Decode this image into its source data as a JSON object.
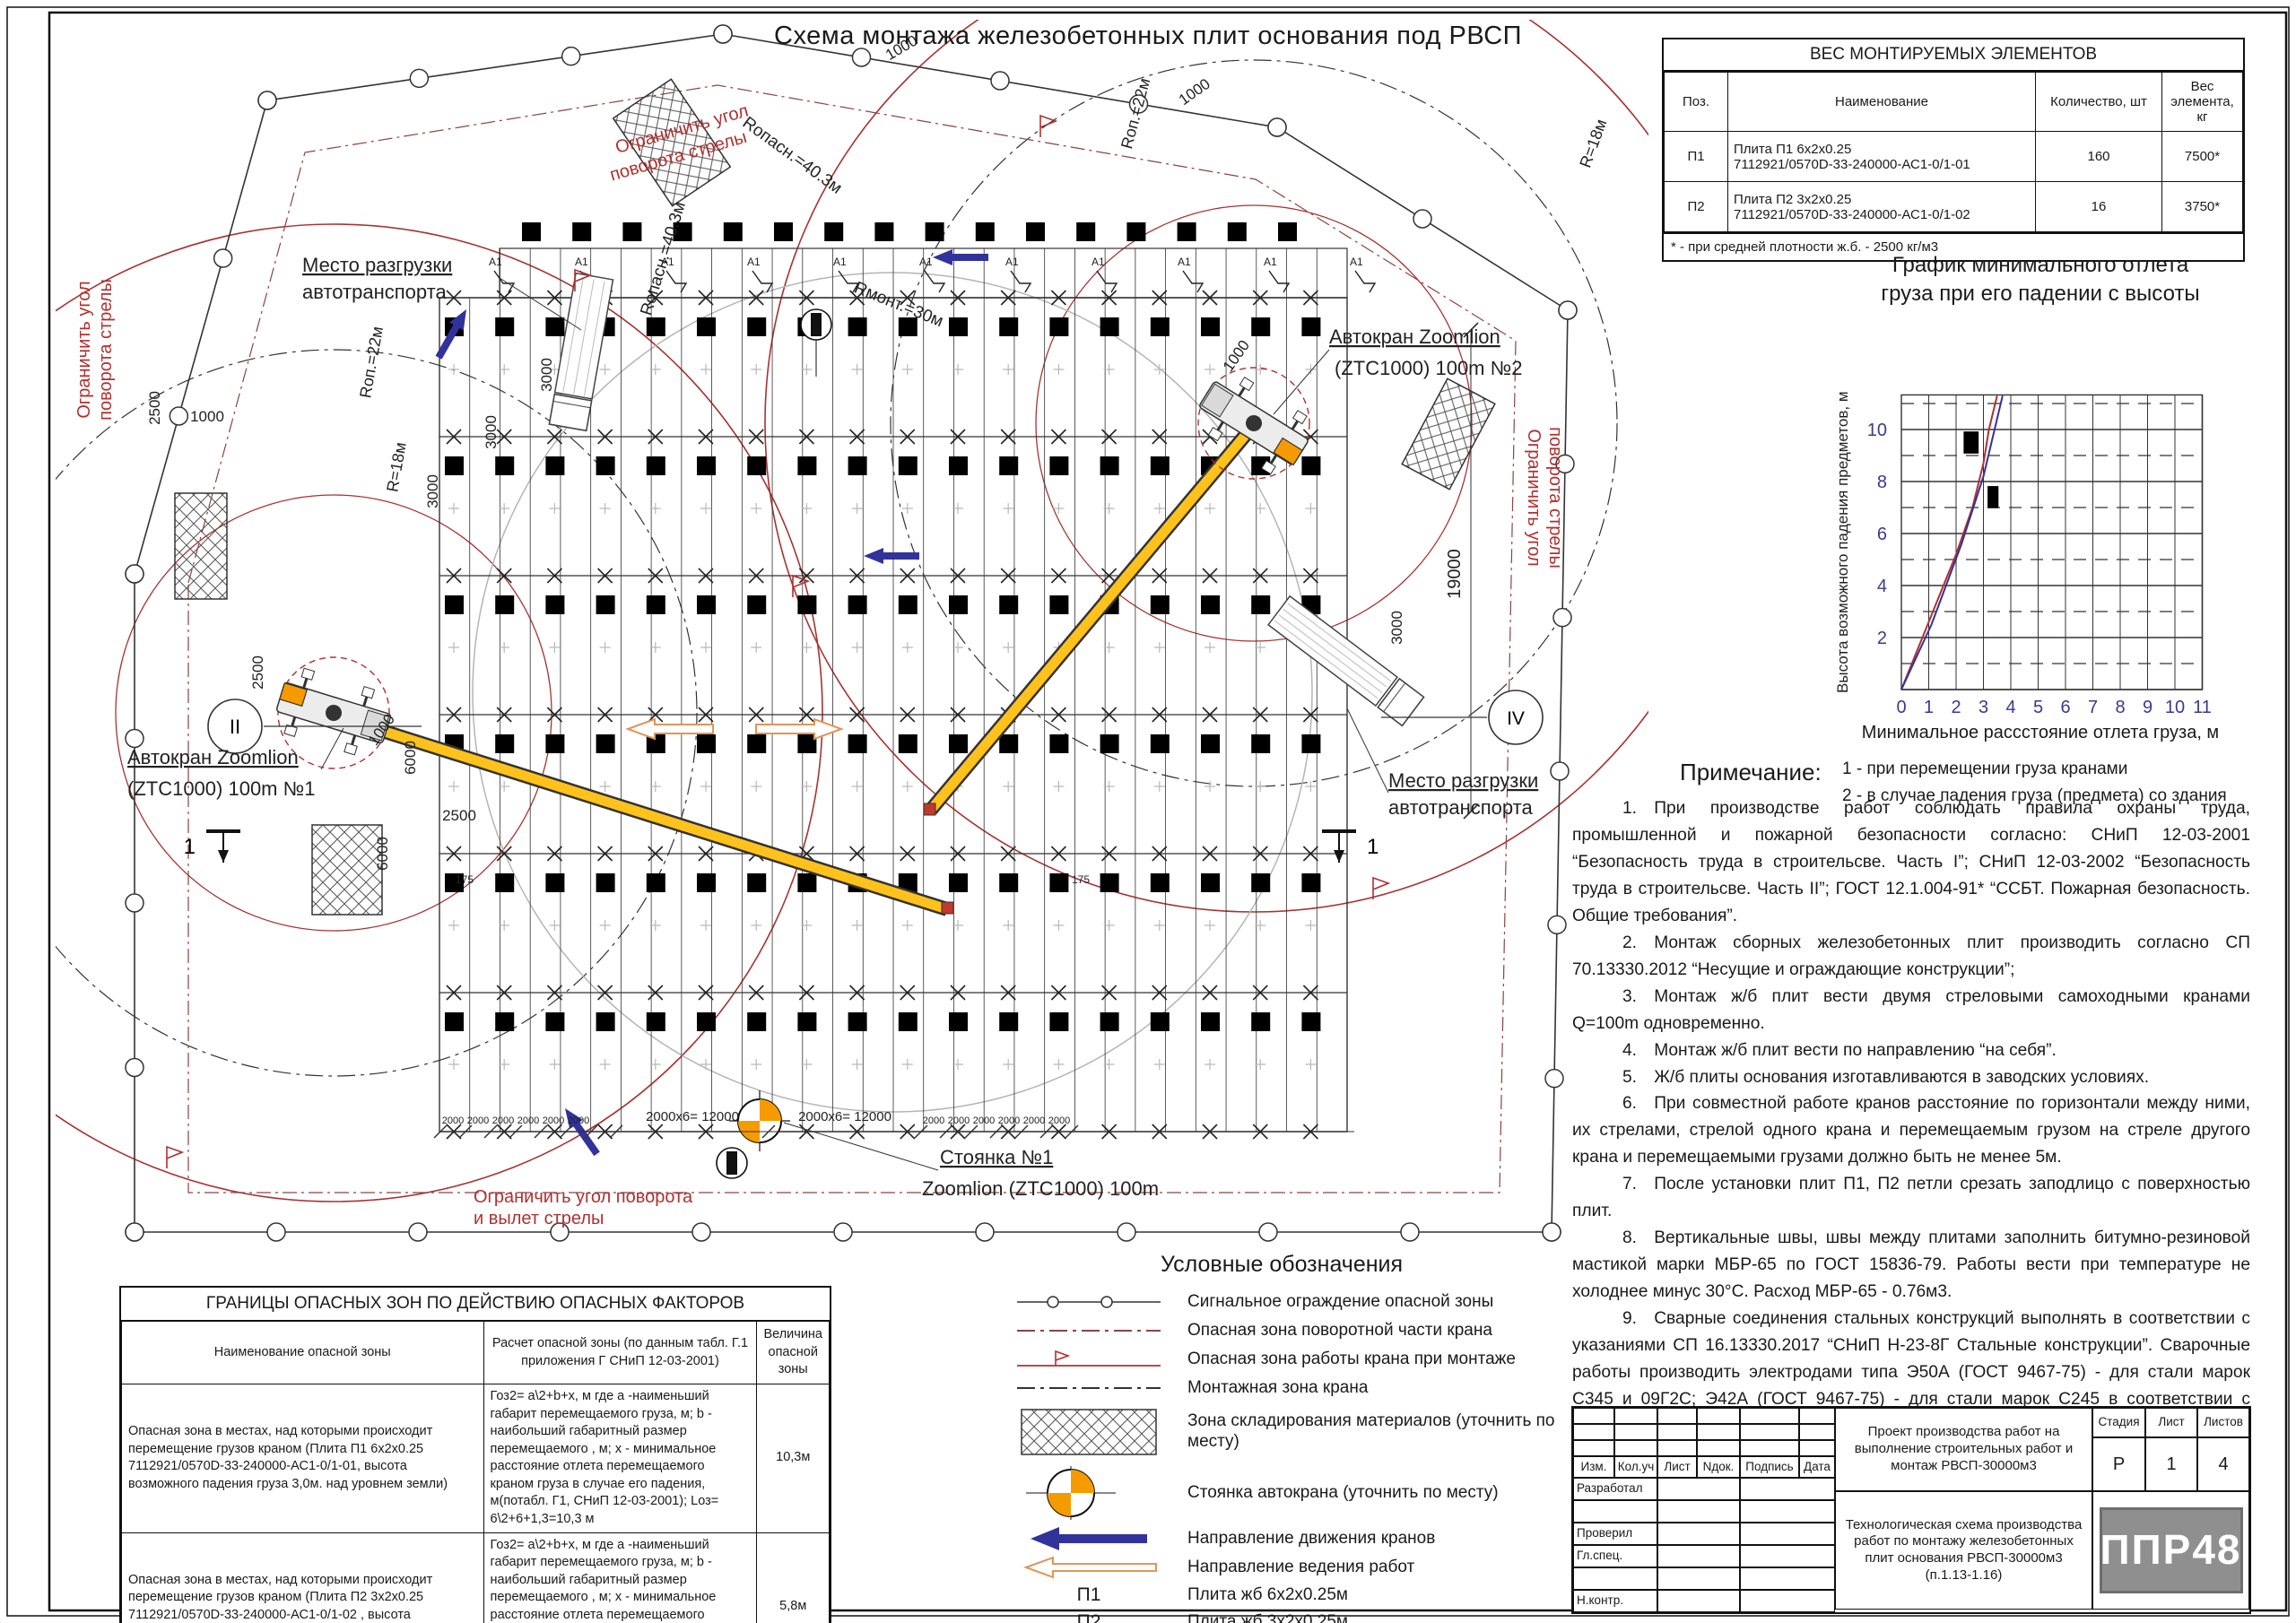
{
  "colors": {
    "red": "#b03030",
    "darkred": "#8a4444",
    "orange": "#f59b00",
    "yellow": "#ffc21c",
    "blue": "#32329b",
    "peach": "#e0955a",
    "grey_line": "#b5b5b5"
  },
  "title": "Схема монтажа железобетонных плит основания под РВСП",
  "weight_table": {
    "title": "ВЕС МОНТИРУЕМЫХ ЭЛЕМЕНТОВ",
    "col_pos": "Поз.",
    "col_name": "Наименование",
    "col_qty": "Количество, шт",
    "col_wt": "Вес элемента, кг",
    "rows": [
      {
        "pos": "П1",
        "name1": "Плита П1 6х2х0.25",
        "name2": "7112921/0570D-33-240000-АС1-0/1-01",
        "qty": "160",
        "wt": "7500*"
      },
      {
        "pos": "П2",
        "name1": "Плита П2 3х2х0.25",
        "name2": "7112921/0570D-33-240000-АС1-0/1-02",
        "qty": "16",
        "wt": "3750*"
      }
    ],
    "footnote": "* - при средней плотности ж.б. - 2500 кг/м3"
  },
  "chart": {
    "title1": "График минимального отлета",
    "title2": "груза при его падении с высоты",
    "note1": "1 - при перемещении груза кранами",
    "note2": "2 - в случае падения груза (предмета) со здания"
  },
  "chart_data": {
    "type": "line",
    "title": "График минимального отлета груза при его падении с высоты",
    "xlabel": "Минимальное рассстояние отлета груза, м",
    "ylabel": "Высота возможного падения предметов, м",
    "xlim": [
      0,
      11
    ],
    "ylim": [
      0,
      11.3
    ],
    "xticks": [
      0,
      1,
      2,
      3,
      4,
      5,
      6,
      7,
      8,
      9,
      10,
      11
    ],
    "yticks": [
      2,
      4,
      6,
      8,
      10
    ],
    "grid": "vertical solid each unit; horizontal solid at even, dashed at odd; legend below",
    "series": [
      {
        "name": "1 - при перемещении груза кранами",
        "color": "#b03030",
        "x": [
          0,
          1,
          2,
          2.6,
          3.0,
          3.2,
          3.5
        ],
        "y": [
          0,
          2.6,
          5.2,
          7.0,
          8.7,
          10.0,
          11.3
        ]
      },
      {
        "name": "2 - в случае падения груза (предмета) со здания",
        "color": "#32329b",
        "x": [
          0,
          1.1,
          2.2,
          3.0,
          3.7
        ],
        "y": [
          0,
          2.5,
          5.6,
          8.2,
          11.3
        ]
      }
    ],
    "markers": [
      {
        "x": 2.55,
        "y": 9.5,
        "w": 0.55,
        "h": 0.85
      },
      {
        "x": 3.35,
        "y": 7.4,
        "w": 0.4,
        "h": 0.85
      }
    ]
  },
  "notes": {
    "title": "Примечание:",
    "items": [
      "1. При производстве работ соблюдать правила охраны труда, промышленной и пожарной безопасности согласно: СНиП 12-03-2001 “Безопасность труда в строительсве. Часть I”; СНиП 12-03-2002 “Безопасность труда в строительсве. Часть II”; ГОСТ 12.1.004-91* “ССБТ. Пожарная безопасность. Общие требования”.",
      "2. Монтаж сборных железобетонных плит производить согласно СП 70.13330.2012 “Несущие и ограждающие конструкции”;",
      "3. Монтаж ж/б плит вести двумя стреловыми самоходными кранами Q=100m одновременно.",
      "4. Монтаж ж/б плит вести по направлению “на себя”.",
      "5. Ж/б плиты основания изготавливаются в заводских условиях.",
      "6. При совместной работе кранов расстояние по горизонтали между ними, их стрелами, стрелой одного крана и перемещаемым грузом на стреле другого крана и перемещаемыми грузами должно быть не менее 5м.",
      "7. После установки плит П1, П2 петли срезать заподлицо с поверхностью плит.",
      "8. Вертикальные швы, швы между плитами заполнить битумно-резиновой мастикой марки МБР-65 по ГОСТ 15836-79. Работы вести при температуре не холоднее минус 30°С. Расход МБР-65 - 0.76м3.",
      "9. Сварные соединения стальных конструкций выполнять в соответствии с указаниями СП 16.13330.2017 “СНиП Н-23-8Г Стальные конструкции”. Сварочные работы производить электродами типа Э50А (ГОСТ 9467-75) - для стали марок С345 и 09Г2С; Э42А (ГОСТ 9467-75) - для стали марок С245 в соответствии с требованиями ГОСТ 5264-80. Высоту шва принять по наименьшей толщине свариваемых элементов.",
      "10. Разрез 1-1 смотри лист 2."
    ]
  },
  "danger_table": {
    "title": "ГРАНИЦЫ ОПАСНЫХ ЗОН ПО ДЕЙСТВИЮ ОПАСНЫХ ФАКТОРОВ",
    "h_name": "Наименование опасной зоны",
    "h_calc": "Расчет опасной зоны (по данным табл. Г.1 приложения Г СНиП 12-03-2001)",
    "h_val": "Величина опасной зоны",
    "rows": [
      {
        "name": "Опасная зона в местах, над которыми происходит перемещение грузов краном (Плита П1 6х2х0.25 7112921/0570D-33-240000-АС1-0/1-01, высота возможного падения груза 3,0м. над уровнем земли)",
        "calc": "Гоз2= а\\2+b+х, м где а -наименьший габарит перемещаемого груза, м; b - наибольший габаритный размер перемещаемого , м; х - минимальное расстояние отлета перемещаемого краном груза в случае его падения, м(потабл. Г1, СНиП 12-03-2001); Lоз= 6\\2+6+1,3=10,3 м",
        "val": "10,3м"
      },
      {
        "name": "Опасная зона в местах, над которыми происходит перемещение грузов краном (Плита П2 3х2х0.25 7112921/0570D-33-240000-АС1-0/1-02 , высота возможного падения груза 3,0м. над уровнем земли)",
        "calc": "Гоз2= а\\2+b+х, м где а -наименьший габарит перемещаемого груза, м; b - наибольший габаритный размер перемещаемого , м; х - минимальное расстояние отлета перемещаемого краном груза в случае его падения, м(потабл. Г1, СНиП 12-03-2001); Lоз= 3\\2+3+1,3=5,8 м",
        "val": "5,8м"
      }
    ]
  },
  "legend": {
    "title": "Условные обозначения",
    "items": [
      {
        "icon": "signal-fence",
        "label": "Сигнальное ограждение опасной зоны"
      },
      {
        "icon": "red-dashdot",
        "label": "Опасная зона поворотной части крана"
      },
      {
        "icon": "red-flag-line",
        "label": "Опасная зона работы крана при монтаже"
      },
      {
        "icon": "black-dashdot",
        "label": "Монтажная зона крана"
      },
      {
        "icon": "hatch-zone",
        "label": "Зона складирования материалов (уточнить по месту)"
      },
      {
        "icon": "crane-parking",
        "label": "Стоянка автокрана (уточнить по месту)"
      },
      {
        "icon": "blue-arrow",
        "label": "Направление движения кранов"
      },
      {
        "icon": "orange-arrow",
        "label": "Направление ведения работ"
      },
      {
        "icon": "П1",
        "label": "Плита жб 6х2х0.25м"
      },
      {
        "icon": "П2",
        "label": "Плита жб 3х2х0.25м"
      },
      {
        "icon": "А1",
        "label": "Анкер Ф10А240"
      }
    ]
  },
  "stamp": {
    "rev_cols": [
      "Изм.",
      "Кол.уч",
      "Лист",
      "Nдок.",
      "Подпись",
      "Дата"
    ],
    "roles": [
      "Разработал",
      "",
      "Проверил",
      "Гл.спец.",
      "",
      "Н.контр."
    ],
    "doc1": "Проект производства работ на выполнение строительных работ и монтаж РВСП-30000м3",
    "doc2": "Технологическая схема производства работ по монтажу железобетонных плит основания РВСП-30000м3  (п.1.13-1.16)",
    "stage_h": "Стадия",
    "sheet_h": "Лист",
    "sheets_h": "Листов",
    "stage": "Р",
    "sheet": "1",
    "sheets": "4",
    "logo": "ППР48"
  },
  "plan": {
    "unload1": "Место разгрузки",
    "unload2": "автотранспорта",
    "crane1a": "Автокран Zoomlion",
    "crane1b": "(ZTC1000) 100m №1",
    "crane2a": "Автокран Zoomlion",
    "crane2b": "(ZTC1000) 100m №2",
    "parking1": "Стоянка №1",
    "parking2": "Zoomlion (ZTC1000) 100m",
    "limit1": "Ограничить угол",
    "limit2": "поворота стрелы",
    "limit_b1": "Ограничить угол поворота",
    "limit_b2": "и вылет стрелы",
    "r_opasn": "Rопасн.=40.3м",
    "r_mont": "Rмонт.=30м",
    "r_pov": "Rоп.=22м",
    "r_18": "R=18м",
    "axis_II": "II",
    "axis_IV": "IV",
    "section": "1",
    "anchor": "А1",
    "dims": {
      "d1000": "1000",
      "d2500": "2500",
      "d3000": "3000",
      "d6000": "6000",
      "d19000": "19000",
      "d175": "175",
      "d2000": "2000",
      "d12000": "2000х6= 12000"
    }
  }
}
